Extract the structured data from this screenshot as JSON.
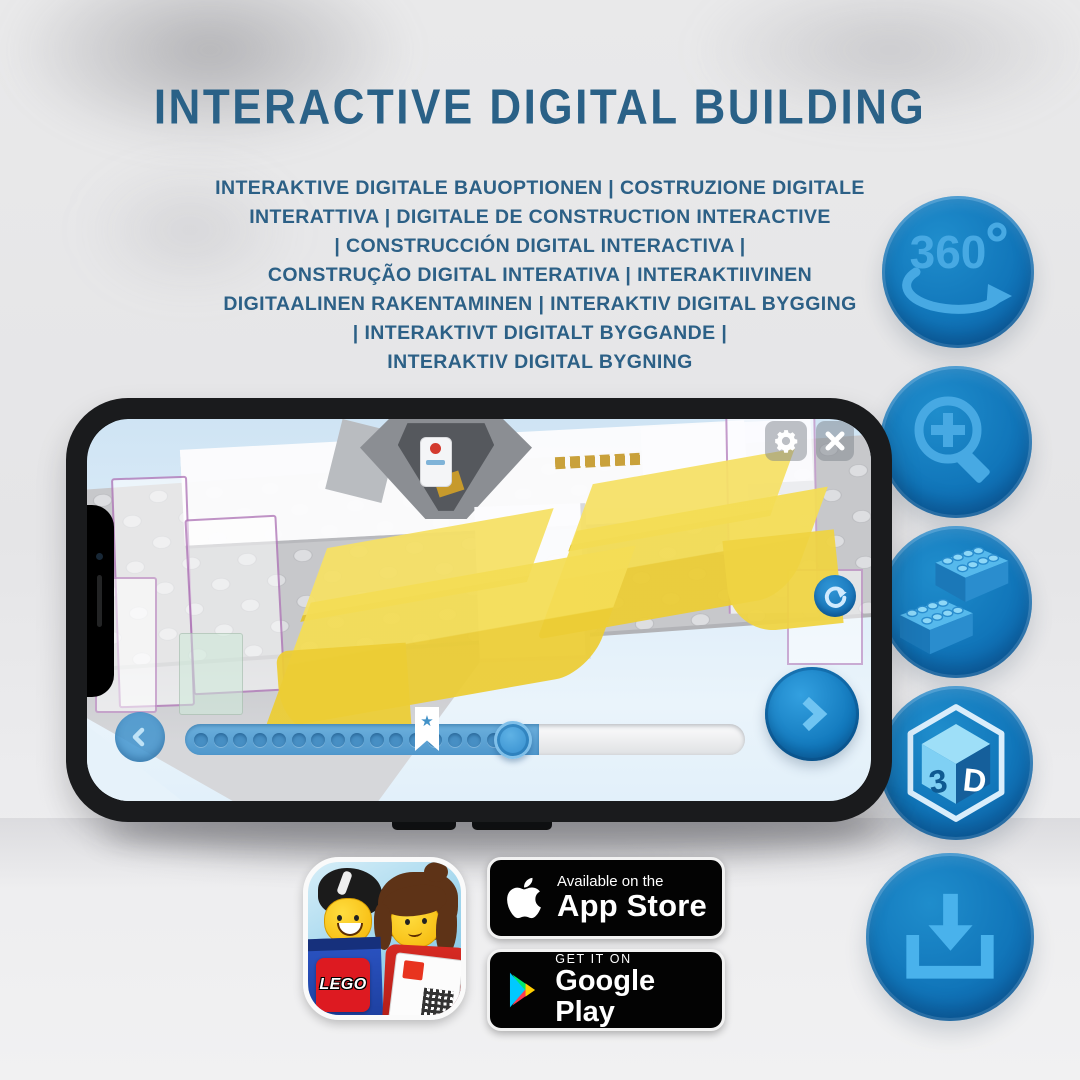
{
  "header": {
    "title": "INTERACTIVE DIGITAL BUILDING"
  },
  "subtitle": {
    "lines": [
      "INTERAKTIVE DIGITALE BAUOPTIONEN | COSTRUZIONE DIGITALE",
      "INTERATTIVA | DIGITALE DE CONSTRUCTION INTERACTIVE",
      "| CONSTRUCCIÓN DIGITAL INTERACTIVA |",
      "CONSTRUÇÃO DIGITAL INTERATIVA | INTERAKTIIVINEN",
      "DIGITAALINEN RAKENTAMINEN | INTERAKTIV DIGITAL BYGGING",
      "| INTERAKTIVT DIGITALT BYGGANDE |",
      "INTERAKTIV DIGITAL BYGNING"
    ]
  },
  "features": {
    "rotation": {
      "name": "360-degree-rotation",
      "label": "360",
      "degree_symbol": "º"
    },
    "zoom": {
      "name": "zoom-in-magnifier"
    },
    "bricks": {
      "name": "building-bricks"
    },
    "cube": {
      "name": "3d-view-cube",
      "left_label": "3",
      "right_label": "D"
    },
    "download": {
      "name": "download"
    }
  },
  "phone_app": {
    "progress": {
      "star_glyph": "★",
      "steps_total": 17,
      "value_percent": 62
    },
    "icons": {
      "settings": "gear",
      "close": "x-cross",
      "rotate": "circular-arrow",
      "back": "chevron-left",
      "next": "chevron-right"
    }
  },
  "store_badges": {
    "app_store": {
      "line1": "Available on the",
      "line2": "App Store"
    },
    "google_play": {
      "line1": "GET IT ON",
      "line2": "Google Play"
    }
  },
  "app_icon": {
    "wordmark": "LEGO"
  },
  "colors": {
    "title_blue": "#2a6187",
    "circle_blue": "#0f6db2",
    "icon_light_blue": "#49b0ea",
    "brick_yellow": "#f0d440",
    "screen_sky_blue": "#d9eaf7",
    "badge_black": "#030303"
  }
}
